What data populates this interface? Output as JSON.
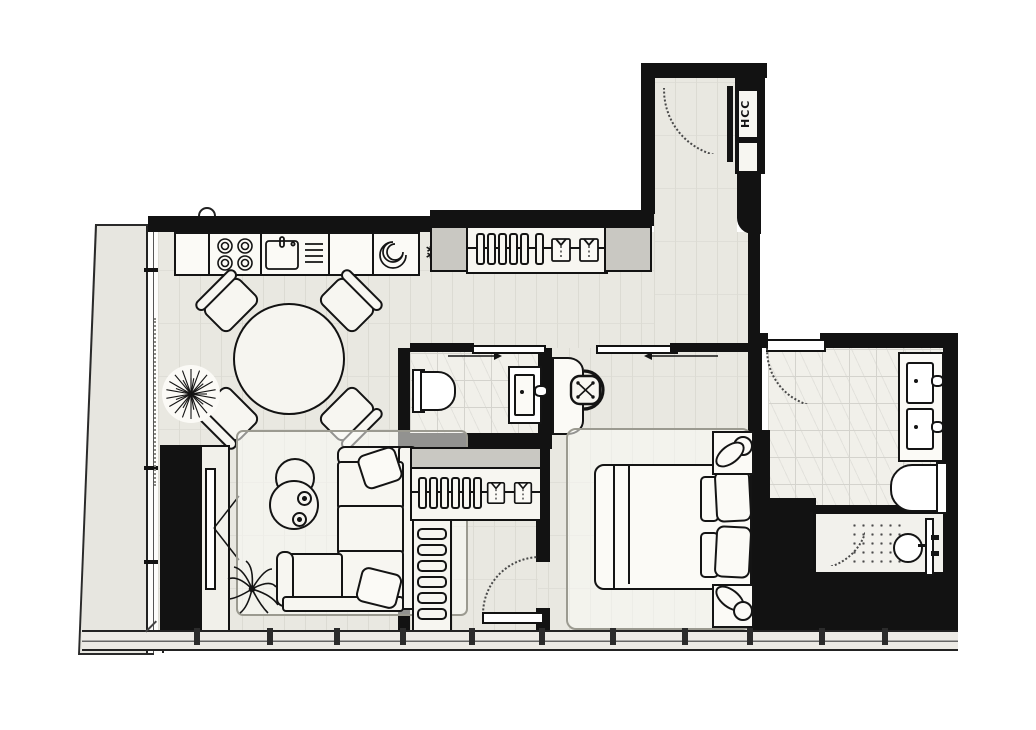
{
  "floorplan": {
    "labels": {
      "riser_shaft": "HCC"
    },
    "colors": {
      "wall": "#121212",
      "wood_floor": "#e9e8e1",
      "plank_line": "#dcdbd3",
      "tile_floor": "#f1f0ea",
      "tile_line": "#d4d3cd",
      "balcony_floor": "#e7e6e0",
      "shaft_gray": "#c9c8c2",
      "furniture_fill": "#f7f6f1",
      "rug_border": "#9b9a90"
    },
    "rooms": [
      "entry-hall",
      "kitchen",
      "living-dining",
      "balcony",
      "wc",
      "walk-in-closet",
      "bedroom",
      "bathroom",
      "shower"
    ],
    "icons": [
      "cooktop-icon",
      "sink-icon",
      "washing-machine-icon",
      "snowflake-icon",
      "hanger-icon",
      "shirt-icon",
      "dining-table",
      "dining-chair",
      "plant-icon",
      "tv-icon",
      "coffee-table",
      "sofa",
      "toilet-icon",
      "vanity-sink-icon",
      "desk-chair-icon",
      "double-bed",
      "table-lamp-icon",
      "shower-head-icon",
      "door-swing-arc",
      "sliding-door-arrow",
      "window-mullion"
    ],
    "snowflake_glyph": "❄"
  }
}
